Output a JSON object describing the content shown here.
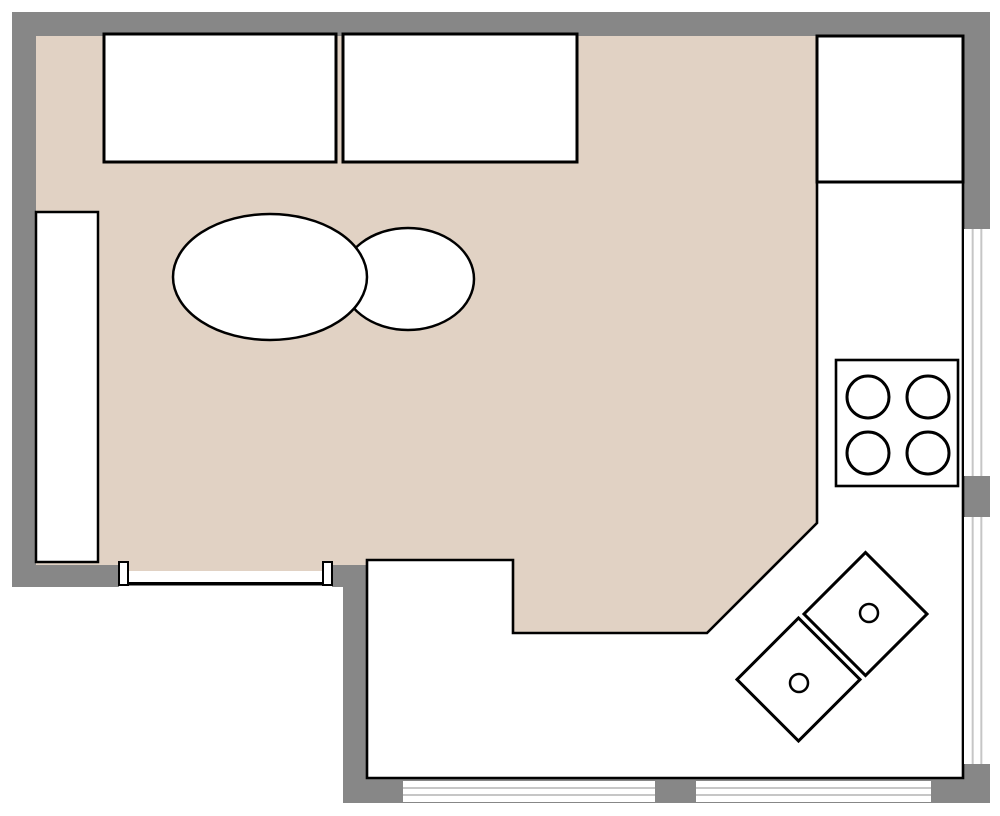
{
  "canvas": {
    "width": 1000,
    "height": 816,
    "background": "#ffffff"
  },
  "colors": {
    "wall": "#878787",
    "living_floor": "#e1d2c4",
    "kitchen_floor": "#ffffff",
    "outline": "#000000",
    "furniture_fill": "#ffffff",
    "window_glass": "#ffffff",
    "window_frame": "#c6c6c6"
  },
  "walls": [
    {
      "name": "wall-top",
      "x": 12,
      "y": 12,
      "w": 978,
      "h": 24
    },
    {
      "name": "wall-left",
      "x": 12,
      "y": 12,
      "w": 24,
      "h": 575
    },
    {
      "name": "wall-right",
      "x": 963,
      "y": 12,
      "w": 27,
      "h": 791
    },
    {
      "name": "wall-bottom-living",
      "x": 12,
      "y": 563,
      "w": 355,
      "h": 24
    },
    {
      "name": "wall-kitchen-left",
      "x": 343,
      "y": 563,
      "w": 24,
      "h": 240
    },
    {
      "name": "wall-kitchen-bottom",
      "x": 343,
      "y": 779,
      "w": 647,
      "h": 24
    }
  ],
  "floors": [
    {
      "name": "living-room-floor",
      "fill": "living_floor",
      "stroke": false,
      "points": [
        [
          36,
          36
        ],
        [
          817,
          36
        ],
        [
          817,
          523
        ],
        [
          707,
          633
        ],
        [
          513,
          633
        ],
        [
          513,
          560
        ],
        [
          367,
          560
        ],
        [
          367,
          565
        ],
        [
          36,
          565
        ]
      ]
    },
    {
      "name": "kitchen-floor",
      "fill": "kitchen_floor",
      "stroke": true,
      "stroke_width": 2.6,
      "points": [
        [
          367,
          560
        ],
        [
          513,
          560
        ],
        [
          513,
          633
        ],
        [
          707,
          633
        ],
        [
          817,
          523
        ],
        [
          817,
          36
        ],
        [
          963,
          36
        ],
        [
          963,
          778
        ],
        [
          367,
          778
        ]
      ]
    }
  ],
  "windows": [
    {
      "name": "window-right-upper",
      "x": 964,
      "y": 229,
      "w": 26,
      "h": 247,
      "dir": "v"
    },
    {
      "name": "window-right-lower",
      "x": 964,
      "y": 517,
      "w": 26,
      "h": 247,
      "dir": "v"
    },
    {
      "name": "window-bottom-left",
      "x": 403,
      "y": 781,
      "w": 252,
      "h": 21,
      "dir": "h"
    },
    {
      "name": "window-bottom-right",
      "x": 696,
      "y": 781,
      "w": 235,
      "h": 21,
      "dir": "h"
    }
  ],
  "door": {
    "name": "doorway-bottom-left",
    "opening": {
      "x": 119,
      "y": 563,
      "w": 213,
      "h": 24
    },
    "floor_strip": {
      "x": 128,
      "y": 563,
      "w": 195,
      "h": 8
    },
    "jambs": [
      {
        "name": "door-jamb-left",
        "x": 119,
        "y": 562,
        "w": 9,
        "h": 23
      },
      {
        "name": "door-jamb-right",
        "x": 323,
        "y": 562,
        "w": 9,
        "h": 23
      }
    ],
    "threshold": {
      "x": 128,
      "y": 582,
      "w": 195,
      "h": 3.5
    }
  },
  "furniture": [
    {
      "type": "rect",
      "name": "cabinet-left-wall",
      "x": 36,
      "y": 212,
      "w": 62,
      "h": 350,
      "sw": 2.5
    },
    {
      "type": "rect",
      "name": "sofa-top-left",
      "x": 104,
      "y": 34,
      "w": 232,
      "h": 128,
      "sw": 3
    },
    {
      "type": "rect",
      "name": "sofa-top-right",
      "x": 343,
      "y": 34,
      "w": 234,
      "h": 128,
      "sw": 3
    },
    {
      "type": "ellipse",
      "name": "table-oval-small",
      "cx": 408,
      "cy": 279,
      "rx": 66,
      "ry": 51,
      "sw": 2.5
    },
    {
      "type": "ellipse",
      "name": "table-oval-large",
      "cx": 270,
      "cy": 277,
      "rx": 97,
      "ry": 63,
      "sw": 2.5
    },
    {
      "type": "rect",
      "name": "refrigerator",
      "x": 817,
      "y": 36,
      "w": 146,
      "h": 146,
      "sw": 3
    },
    {
      "type": "stove",
      "name": "stove-cooktop",
      "x": 836,
      "y": 360,
      "w": 122,
      "h": 126,
      "sw": 2.6,
      "burners": [
        {
          "cx": 868,
          "cy": 397,
          "r": 21
        },
        {
          "cx": 928,
          "cy": 397,
          "r": 21
        },
        {
          "cx": 868,
          "cy": 453,
          "r": 21
        },
        {
          "cx": 928,
          "cy": 453,
          "r": 21
        }
      ]
    },
    {
      "type": "diamond",
      "name": "island-cabinet-upper",
      "cx": 865.5,
      "cy": 614,
      "side": 87,
      "rotation": 45,
      "sw": 3,
      "knob": {
        "cx": 869,
        "cy": 613,
        "r": 9
      }
    },
    {
      "type": "diamond",
      "name": "island-cabinet-lower",
      "cx": 798.5,
      "cy": 679.5,
      "side": 87,
      "rotation": 45,
      "sw": 3,
      "knob": {
        "cx": 799,
        "cy": 683,
        "r": 9
      }
    }
  ]
}
